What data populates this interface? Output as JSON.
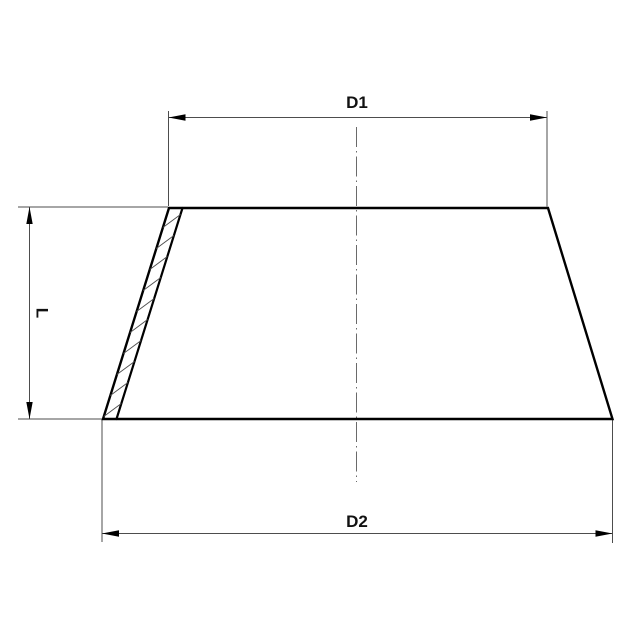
{
  "drawing": {
    "dimension_labels": {
      "d1": "D1",
      "d2": "D2",
      "l": "L"
    },
    "colors": {
      "outline": "#000000",
      "thin_line": "#4d4d4d",
      "centerline": "#6a6a6a",
      "text": "#111111",
      "background": "#ffffff"
    }
  }
}
